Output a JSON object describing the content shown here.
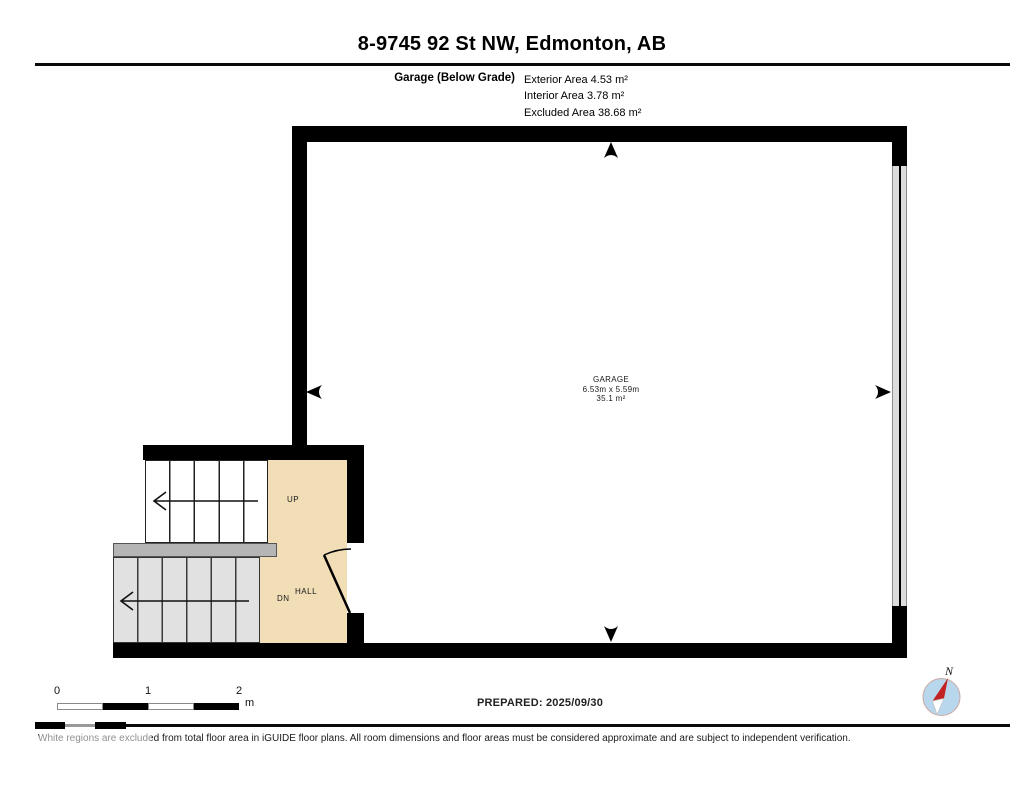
{
  "header": {
    "title": "8-9745 92 St NW, Edmonton, AB",
    "floor_label": "Garage (Below Grade)",
    "areas": [
      "Exterior Area 4.53 m²",
      "Interior Area 3.78 m²",
      "Excluded Area 38.68 m²"
    ]
  },
  "plan": {
    "garage": {
      "name": "GARAGE",
      "dimensions": "6.53m x 5.59m",
      "area": "35.1 m²"
    },
    "labels": {
      "up": "UP",
      "down": "DN",
      "hall": "HALL"
    },
    "colors": {
      "wall": "#000000",
      "hall_floor": "#f1deb6",
      "upper_stairs": "#ffffff",
      "lower_stairs": "#e1e1e1",
      "landing": "#b5b5b5",
      "garage_door": "#dcdcdc",
      "compass_fill": "#b9d7ec",
      "compass_needle": "#c32222"
    }
  },
  "scale_bar": {
    "ticks": [
      "0",
      "1",
      "2"
    ],
    "unit": "m"
  },
  "footer": {
    "prepared": "PREPARED: 2025/09/30",
    "compass_label": "N",
    "disclaimer": "White regions are excluded from total floor area in iGUIDE floor plans. All room dimensions and floor areas must be considered approximate and are subject to independent verification."
  }
}
